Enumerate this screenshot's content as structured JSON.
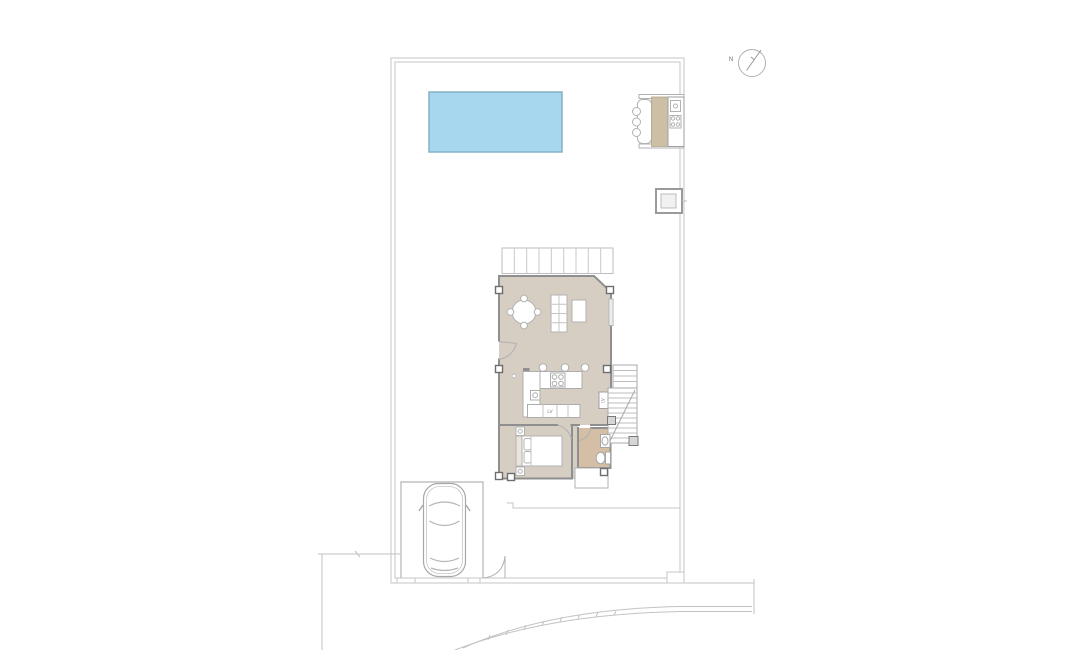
{
  "labels": {
    "compass_north": "N",
    "dishwasher": "LV",
    "laundry": "LV"
  },
  "colors": {
    "background": "#ffffff",
    "floor": "#d7cec3",
    "bathroom_floor": "#d4bfa6",
    "counter_tan": "#cdbfa6",
    "pool_fill": "#a7d7ee",
    "pool_edge": "#85b1c7",
    "wall": "#8f8f8f",
    "furniture_line": "#b2b2b2",
    "boundary_line": "#c6c6c6"
  },
  "inventory": {
    "bar_stools": 3,
    "bbq_stools": 3,
    "pergola_bays": 9,
    "parking_spaces": 1,
    "bedrooms_visible": 1,
    "bathrooms_visible": 1
  }
}
